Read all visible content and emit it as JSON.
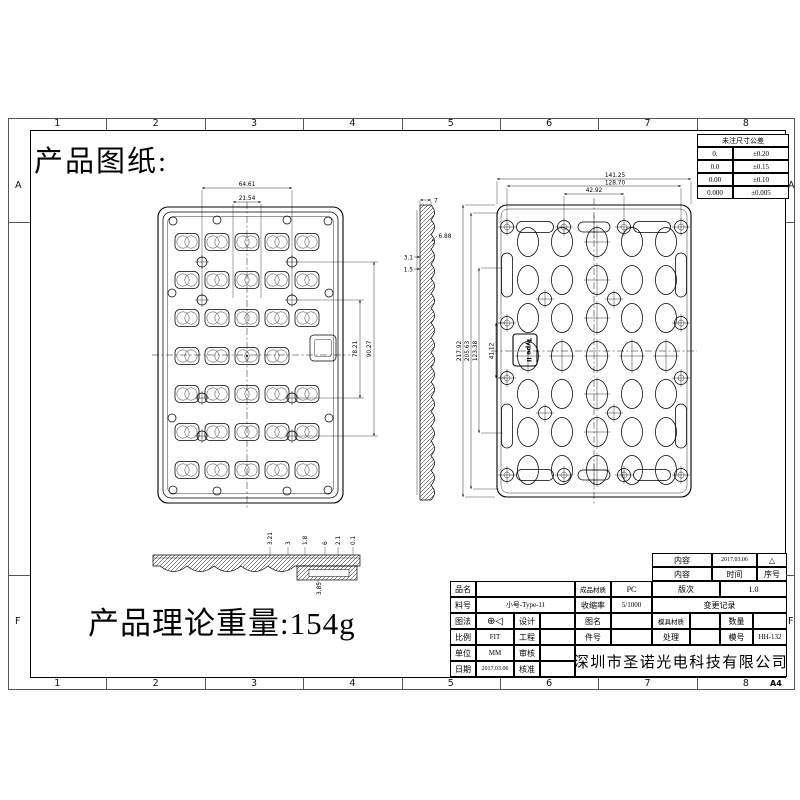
{
  "texts": {
    "title": "产品图纸:",
    "weight": "产品理论重量:154g",
    "sheet_size": "A4"
  },
  "frame": {
    "columns": [
      "1",
      "2",
      "3",
      "4",
      "5",
      "6",
      "7",
      "8"
    ],
    "rows": [
      "A",
      "F"
    ]
  },
  "tolerance_table": {
    "header": "未注尺寸公差",
    "rows": [
      [
        "0.",
        "±0.20"
      ],
      [
        "0.0",
        "±0.15"
      ],
      [
        "0.00",
        "±0.10"
      ],
      [
        "0.000",
        "±0.005"
      ]
    ]
  },
  "views": {
    "front": {
      "dims": {
        "width_outer": "64.61",
        "width_inner": "21.54",
        "height_inner": "78.21",
        "height_outer": "90.27"
      }
    },
    "side_section": {
      "dims": {
        "d1": "7",
        "d2": "6.88",
        "d3": "3.1",
        "d4": "1.5"
      }
    },
    "back": {
      "type_label": "Type II",
      "dims": {
        "w1": "141.25",
        "w2": "128.70",
        "w3": "42.92",
        "h1": "217.92",
        "h2": "205.63",
        "h3": "123.38",
        "h4": "41.12"
      }
    },
    "bottom_section": {
      "dims": {
        "d1": "3.21",
        "d2": "3",
        "d3": "1.8",
        "d4": "6",
        "d5": "2.1",
        "d6": "0.1",
        "d7": "3.85"
      }
    }
  },
  "title_block": {
    "change_log": {
      "r1c1": "内容",
      "r1c2": "2017.03.06",
      "r1c3": "△",
      "r2c1": "内容",
      "r2c2": "时间",
      "r2c3": "序号"
    },
    "revision_label": "版次",
    "revision": "1.0",
    "change_record": "变更记录",
    "mold_material_label": "模具材质",
    "mold_material": "",
    "qty_label": "数量",
    "qty": "",
    "treatment_label": "处理",
    "treatment": "",
    "mold_no_label": "模号",
    "mold_no": "HH-132",
    "material_label": "成品材质",
    "material": "PC",
    "shrink_label": "收缩率",
    "shrink": "5/1000",
    "drawing_name_label": "图名",
    "drawing_name": "",
    "part_no_label": "件号",
    "part_no": "",
    "product_name_label": "品名",
    "product_name": "",
    "part_code_label": "料号",
    "part_code": "小号-Type-11",
    "projection_label": "图法",
    "projection_symbol": "⊕◁",
    "design_label": "设计",
    "design": "",
    "scale_label": "比例",
    "scale": "FIT",
    "engineer_label": "工程",
    "engineer": "",
    "unit_label": "单位",
    "unit": "MM",
    "review_label": "审核",
    "review": "",
    "date_label": "日期",
    "date": "2017.03.06",
    "approve_label": "核准",
    "approve": "",
    "company": "深圳市圣诺光电科技有限公司"
  }
}
